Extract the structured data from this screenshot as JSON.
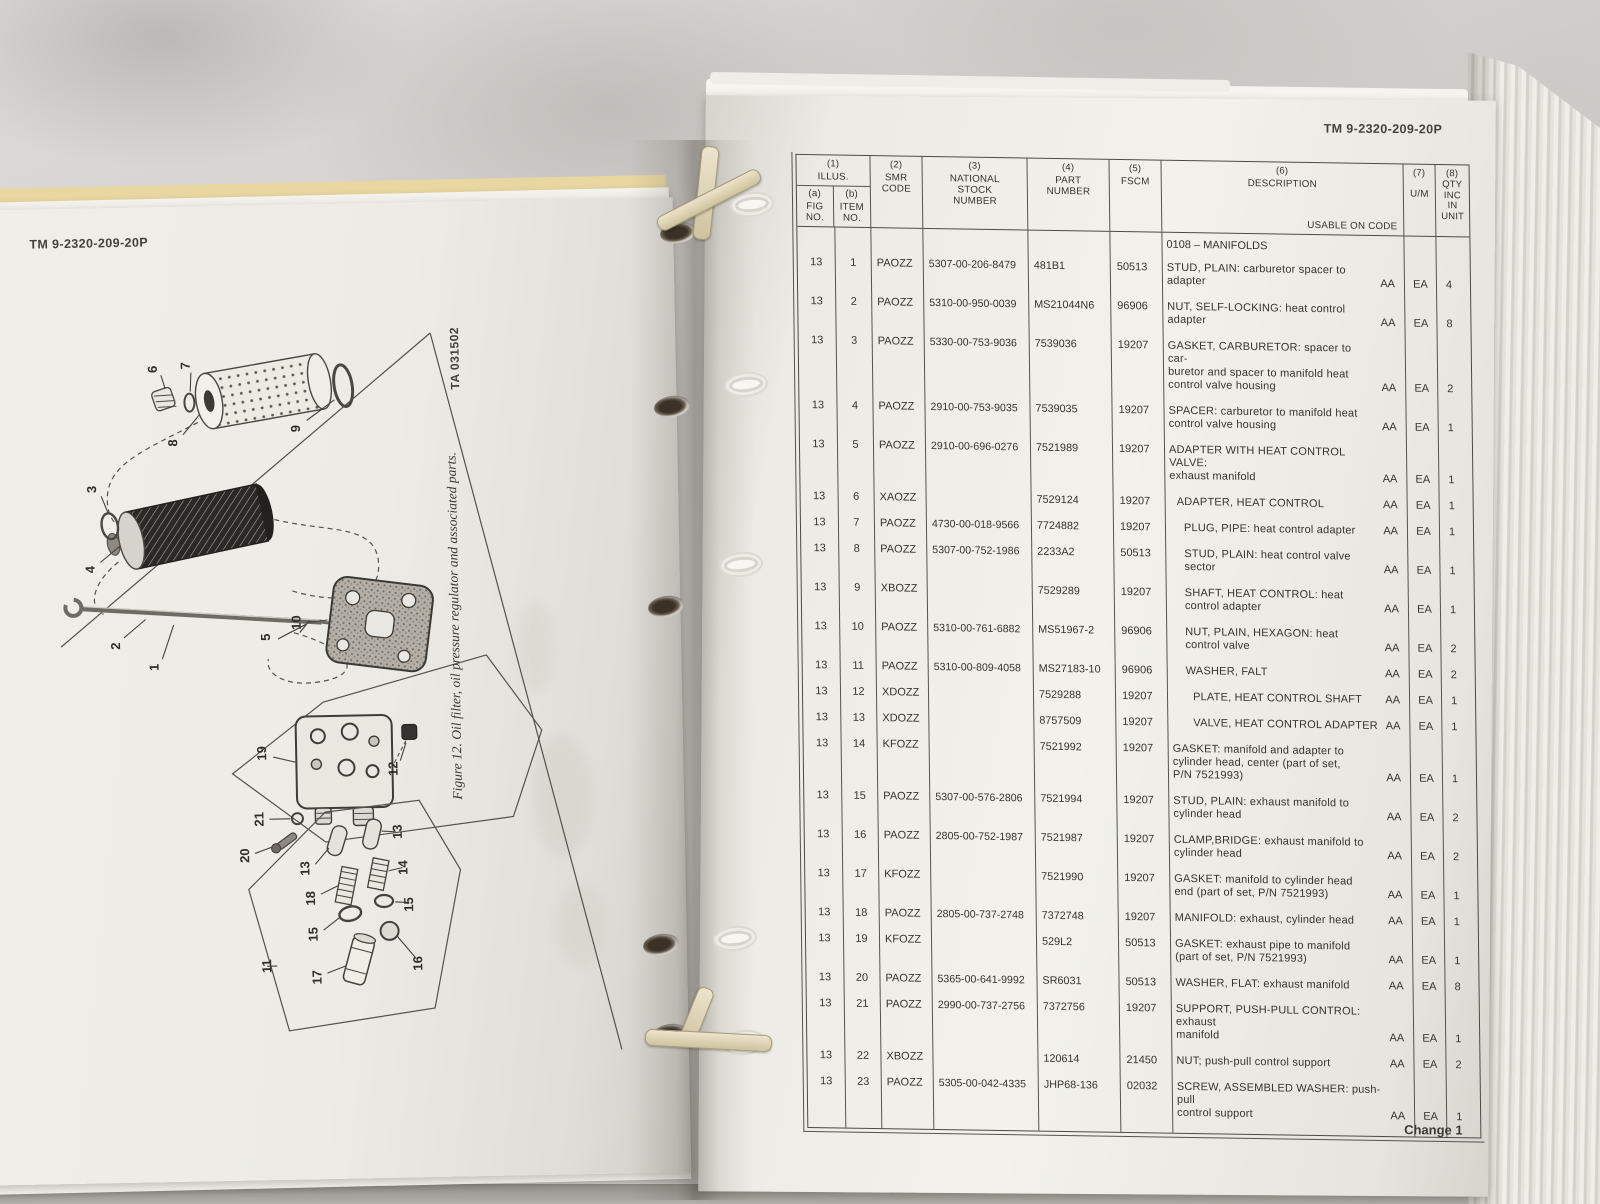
{
  "colors": {
    "paper": "#efede8",
    "marble": "#d3d0cd",
    "manila": "#e3d09a",
    "table_line": "#56534e",
    "ink": "#35332f"
  },
  "left_page": {
    "tm_number": "TM 9-2320-209-20P",
    "figure_caption": "Figure 12. Oil filter, oil pressure regulator and associated parts.",
    "ta_number": "TA 031502",
    "diagram_labels": [
      "1",
      "2",
      "3",
      "4",
      "5",
      "6",
      "7",
      "8",
      "9",
      "10",
      "11",
      "12",
      "13",
      "14",
      "15",
      "16",
      "17",
      "18",
      "19",
      "20",
      "21"
    ]
  },
  "right_page": {
    "tm_number": "TM 9-2320-209-20P",
    "footer": "Change 1",
    "table": {
      "header": {
        "col1_num": "(1)",
        "col1_title": "ILLUS.",
        "col1a_num": "(a)",
        "col1a_title": "FIG\nNO.",
        "col1b_num": "(b)",
        "col1b_title": "ITEM\nNO.",
        "col2_num": "(2)",
        "col2_title": "SMR\nCODE",
        "col3_num": "(3)",
        "col3_title": "NATIONAL\nSTOCK\nNUMBER",
        "col4_num": "(4)",
        "col4_title": "PART\nNUMBER",
        "col5_num": "(5)",
        "col5_title": "FSCM",
        "col6_num": "(6)",
        "col6_title": "DESCRIPTION",
        "col6_sub": "USABLE ON CODE",
        "col7_num": "(7)",
        "col7_title": "U/M",
        "col8_num": "(8)",
        "col8_title": "QTY\nINC\nIN\nUNIT"
      },
      "group_header": "0108 – MANIFOLDS",
      "rows": [
        {
          "fig": "13",
          "item": "1",
          "smr": "PAOZZ",
          "nsn": "5307-00-206-8479",
          "part": "481B1",
          "fscm": "50513",
          "desc": [
            "STUD, PLAIN: carburetor spacer to",
            "adapter"
          ],
          "usable": "AA",
          "um": "EA",
          "qty": "4",
          "indent": 0
        },
        {
          "fig": "13",
          "item": "2",
          "smr": "PAOZZ",
          "nsn": "5310-00-950-0039",
          "part": "MS21044N6",
          "fscm": "96906",
          "desc": [
            "NUT, SELF-LOCKING: heat control",
            "adapter"
          ],
          "usable": "AA",
          "um": "EA",
          "qty": "8",
          "indent": 0
        },
        {
          "fig": "13",
          "item": "3",
          "smr": "PAOZZ",
          "nsn": "5330-00-753-9036",
          "part": "7539036",
          "fscm": "19207",
          "desc": [
            "GASKET, CARBURETOR: spacer to car-",
            "buretor and spacer to manifold heat",
            "control valve housing"
          ],
          "usable": "AA",
          "um": "EA",
          "qty": "2",
          "indent": 0
        },
        {
          "fig": "13",
          "item": "4",
          "smr": "PAOZZ",
          "nsn": "2910-00-753-9035",
          "part": "7539035",
          "fscm": "19207",
          "desc": [
            "SPACER: carburetor to manifold heat",
            "control valve housing"
          ],
          "usable": "AA",
          "um": "EA",
          "qty": "1",
          "indent": 0
        },
        {
          "fig": "13",
          "item": "5",
          "smr": "PAOZZ",
          "nsn": "2910-00-696-0276",
          "part": "7521989",
          "fscm": "19207",
          "desc": [
            "ADAPTER WITH HEAT CONTROL VALVE:",
            "exhaust manifold"
          ],
          "usable": "AA",
          "um": "EA",
          "qty": "1",
          "indent": 0
        },
        {
          "fig": "13",
          "item": "6",
          "smr": "XAOZZ",
          "nsn": "",
          "part": "7529124",
          "fscm": "19207",
          "desc": [
            "ADAPTER, HEAT CONTROL"
          ],
          "usable": "AA",
          "um": "EA",
          "qty": "1",
          "indent": 1
        },
        {
          "fig": "13",
          "item": "7",
          "smr": "PAOZZ",
          "nsn": "4730-00-018-9566",
          "part": "7724882",
          "fscm": "19207",
          "desc": [
            "PLUG, PIPE: heat control adapter"
          ],
          "usable": "AA",
          "um": "EA",
          "qty": "1",
          "indent": 2
        },
        {
          "fig": "13",
          "item": "8",
          "smr": "PAOZZ",
          "nsn": "5307-00-752-1986",
          "part": "2233A2",
          "fscm": "50513",
          "desc": [
            "STUD, PLAIN: heat control valve",
            "sector"
          ],
          "usable": "AA",
          "um": "EA",
          "qty": "1",
          "indent": 2
        },
        {
          "fig": "13",
          "item": "9",
          "smr": "XBOZZ",
          "nsn": "",
          "part": "7529289",
          "fscm": "19207",
          "desc": [
            "SHAFT, HEAT CONTROL: heat",
            "control adapter"
          ],
          "usable": "AA",
          "um": "EA",
          "qty": "1",
          "indent": 2
        },
        {
          "fig": "13",
          "item": "10",
          "smr": "PAOZZ",
          "nsn": "5310-00-761-6882",
          "part": "MS51967-2",
          "fscm": "96906",
          "desc": [
            "NUT, PLAIN, HEXAGON: heat",
            "control valve"
          ],
          "usable": "AA",
          "um": "EA",
          "qty": "2",
          "indent": 2
        },
        {
          "fig": "13",
          "item": "11",
          "smr": "PAOZZ",
          "nsn": "5310-00-809-4058",
          "part": "MS27183-10",
          "fscm": "96906",
          "desc": [
            "WASHER, FALT"
          ],
          "usable": "AA",
          "um": "EA",
          "qty": "2",
          "indent": 2
        },
        {
          "fig": "13",
          "item": "12",
          "smr": "XDOZZ",
          "nsn": "",
          "part": "7529288",
          "fscm": "19207",
          "desc": [
            "PLATE, HEAT CONTROL SHAFT"
          ],
          "usable": "AA",
          "um": "EA",
          "qty": "1",
          "indent": 3
        },
        {
          "fig": "13",
          "item": "13",
          "smr": "XDOZZ",
          "nsn": "",
          "part": "8757509",
          "fscm": "19207",
          "desc": [
            "VALVE, HEAT CONTROL ADAPTER"
          ],
          "usable": "AA",
          "um": "EA",
          "qty": "1",
          "indent": 3
        },
        {
          "fig": "13",
          "item": "14",
          "smr": "KFOZZ",
          "nsn": "",
          "part": "7521992",
          "fscm": "19207",
          "desc": [
            "GASKET: manifold and adapter to",
            "cylinder head, center (part of set,",
            "P/N 7521993)"
          ],
          "usable": "AA",
          "um": "EA",
          "qty": "1",
          "indent": 0
        },
        {
          "fig": "13",
          "item": "15",
          "smr": "PAOZZ",
          "nsn": "5307-00-576-2806",
          "part": "7521994",
          "fscm": "19207",
          "desc": [
            "STUD, PLAIN: exhaust manifold to",
            "cylinder head"
          ],
          "usable": "AA",
          "um": "EA",
          "qty": "2",
          "indent": 0
        },
        {
          "fig": "13",
          "item": "16",
          "smr": "PAOZZ",
          "nsn": "2805-00-752-1987",
          "part": "7521987",
          "fscm": "19207",
          "desc": [
            "CLAMP,BRIDGE: exhaust manifold to",
            "cylinder head"
          ],
          "usable": "AA",
          "um": "EA",
          "qty": "2",
          "indent": 0
        },
        {
          "fig": "13",
          "item": "17",
          "smr": "KFOZZ",
          "nsn": "",
          "part": "7521990",
          "fscm": "19207",
          "desc": [
            "GASKET: manifold to cylinder head",
            "end (part of set, P/N 7521993)"
          ],
          "usable": "AA",
          "um": "EA",
          "qty": "1",
          "indent": 0
        },
        {
          "fig": "13",
          "item": "18",
          "smr": "PAOZZ",
          "nsn": "2805-00-737-2748",
          "part": "7372748",
          "fscm": "19207",
          "desc": [
            "MANIFOLD: exhaust, cylinder head"
          ],
          "usable": "AA",
          "um": "EA",
          "qty": "1",
          "indent": 0
        },
        {
          "fig": "13",
          "item": "19",
          "smr": "KFOZZ",
          "nsn": "",
          "part": "529L2",
          "fscm": "50513",
          "desc": [
            "GASKET: exhaust pipe to manifold",
            "(part of set, P/N 7521993)"
          ],
          "usable": "AA",
          "um": "EA",
          "qty": "1",
          "indent": 0
        },
        {
          "fig": "13",
          "item": "20",
          "smr": "PAOZZ",
          "nsn": "5365-00-641-9992",
          "part": "SR6031",
          "fscm": "50513",
          "desc": [
            "WASHER, FLAT: exhaust manifold"
          ],
          "usable": "AA",
          "um": "EA",
          "qty": "8",
          "indent": 0
        },
        {
          "fig": "13",
          "item": "21",
          "smr": "PAOZZ",
          "nsn": "2990-00-737-2756",
          "part": "7372756",
          "fscm": "19207",
          "desc": [
            "SUPPORT, PUSH-PULL CONTROL: exhaust",
            "manifold"
          ],
          "usable": "AA",
          "um": "EA",
          "qty": "1",
          "indent": 0
        },
        {
          "fig": "13",
          "item": "22",
          "smr": "XBOZZ",
          "nsn": "",
          "part": "120614",
          "fscm": "21450",
          "desc": [
            "NUT; push-pull control support"
          ],
          "usable": "AA",
          "um": "EA",
          "qty": "2",
          "indent": 0
        },
        {
          "fig": "13",
          "item": "23",
          "smr": "PAOZZ",
          "nsn": "5305-00-042-4335",
          "part": "JHP68-136",
          "fscm": "02032",
          "desc": [
            "SCREW, ASSEMBLED WASHER: push-pull",
            "control support"
          ],
          "usable": "AA",
          "um": "EA",
          "qty": "1",
          "indent": 0
        }
      ]
    }
  }
}
